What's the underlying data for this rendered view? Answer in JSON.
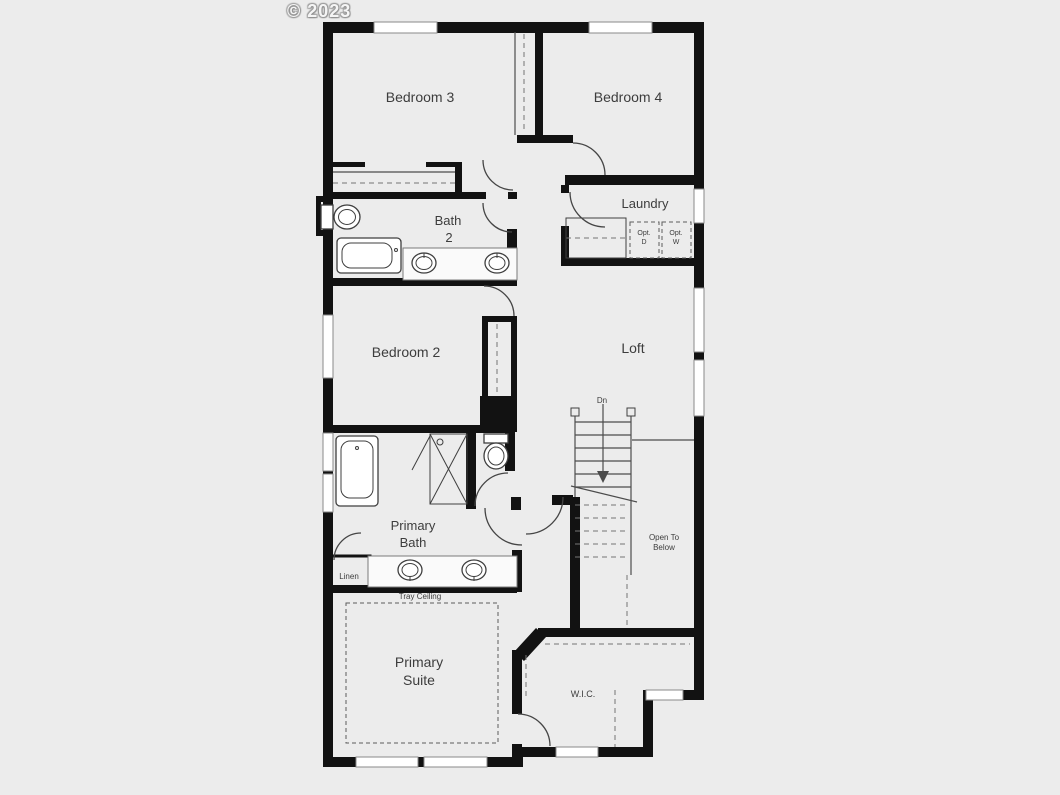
{
  "watermark": "© 2023",
  "labels": {
    "bedroom3": "Bedroom 3",
    "bedroom4": "Bedroom 4",
    "laundry": "Laundry",
    "bath2_line1": "Bath",
    "bath2_line2": "2",
    "bedroom2": "Bedroom 2",
    "loft": "Loft",
    "down": "Dn",
    "open_to_below_line1": "Open To",
    "open_to_below_line2": "Below",
    "primary_bath_line1": "Primary",
    "primary_bath_line2": "Bath",
    "linen": "Linen",
    "tray_ceiling": "Tray Ceiling",
    "primary_suite_line1": "Primary",
    "primary_suite_line2": "Suite",
    "wic": "W.I.C.",
    "opt_dryer_line1": "Opt.",
    "opt_dryer_line2": "D",
    "opt_washer_line1": "Opt.",
    "opt_washer_line2": "W"
  },
  "colors": {
    "background": "#ececec",
    "wall": "#121212",
    "thin_line": "#4c4c4c",
    "dashed_line": "#757575",
    "window_fill": "#ffffff",
    "window_border": "#8a8a8a",
    "label_text": "#3d3d3d",
    "watermark_text": "#f5f5f5"
  }
}
